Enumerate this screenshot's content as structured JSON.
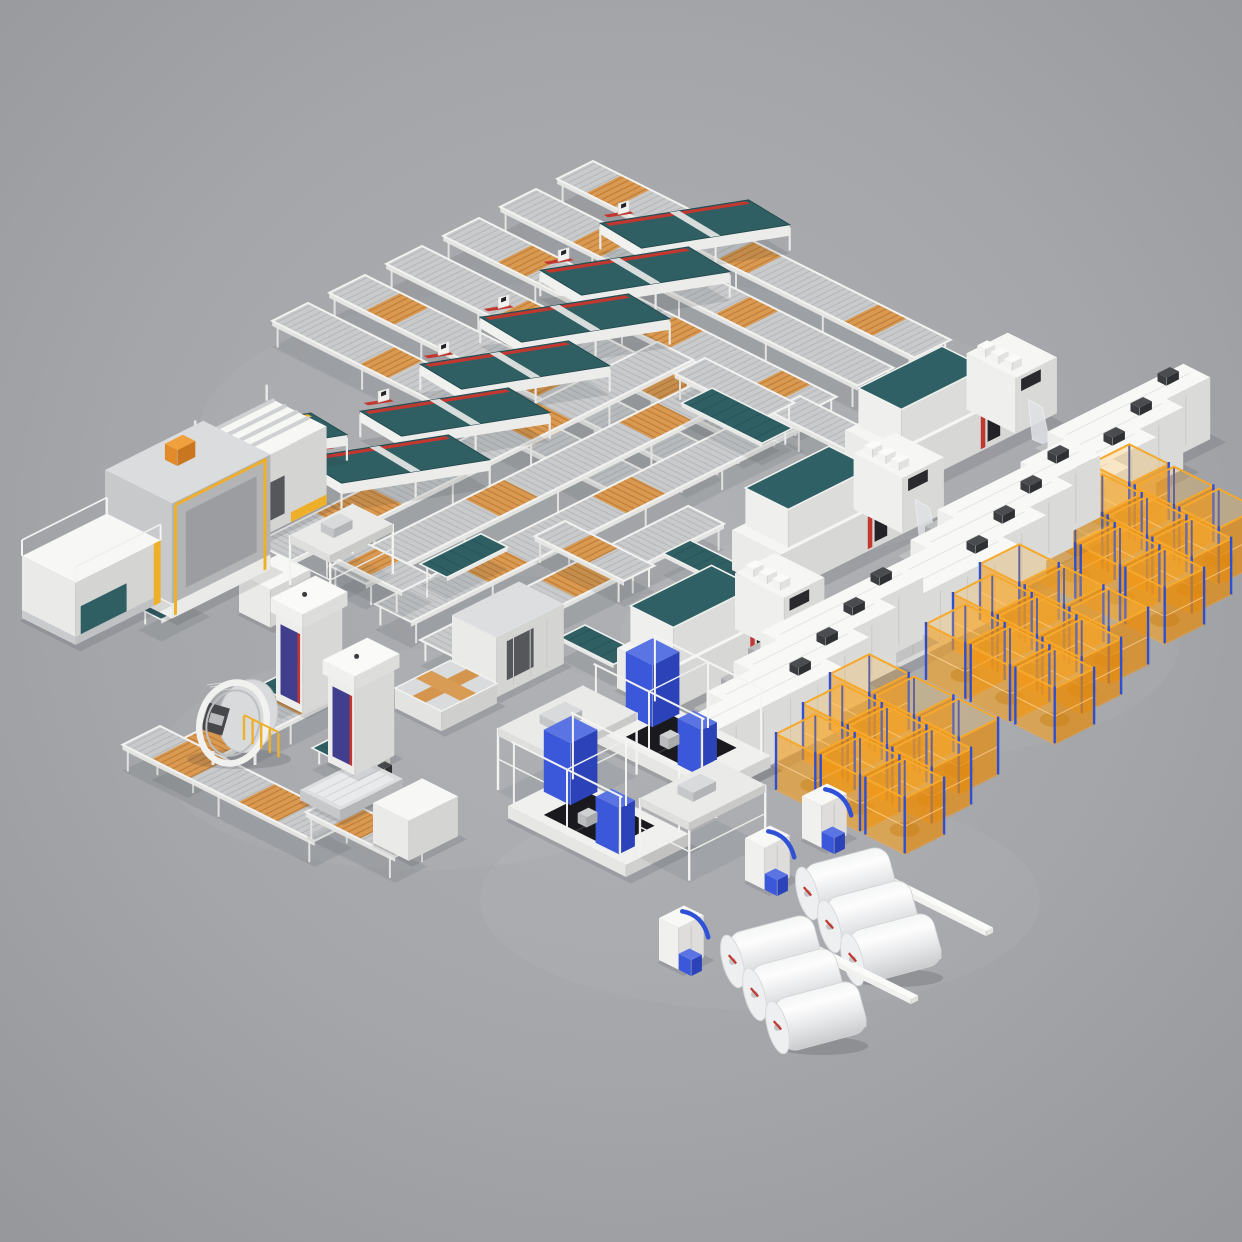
{
  "scene": {
    "subject": "isometric-3d-render-automated-textile-production-line",
    "canvas": {
      "width": 1242,
      "height": 1242
    },
    "palette": {
      "bg_center": "#aeb0b4",
      "bg_mid": "#a4a6aa",
      "bg_edge": "#95979b",
      "frame_white": "#f2f2f0",
      "silver": "#c8cacc",
      "roller_stripe": "#b5b7b9",
      "orange_roller": "#d99950",
      "orange_dark": "#bf7d3a",
      "teal": "#2f5f63",
      "teal_dark": "#27545a",
      "red": "#c23730",
      "yellow": "#eeb02a",
      "cage_orange": "#f4a01a",
      "cage_blue": "#2d4fd4",
      "machine_blue": "#3c58da",
      "machine_blue_dark": "#2b42b8",
      "indigo_door": "#413e8e",
      "black_panel": "#1a1a1e",
      "body_gray": "#c7c9cb",
      "shadow": "rgba(44,46,52,0.13)"
    },
    "elements": [
      {
        "type": "conv",
        "name": "grid-rail-b1",
        "dir": "B",
        "x": 593,
        "y": 185,
        "len": 400,
        "w": 40,
        "orange": [
          [
            0.08,
            0.16
          ],
          [
            0.45,
            0.53
          ],
          [
            0.8,
            0.88
          ]
        ]
      },
      {
        "type": "conv",
        "name": "grid-rail-b2",
        "dir": "B",
        "x": 536,
        "y": 213,
        "len": 400,
        "w": 40,
        "orange": [
          [
            0.2,
            0.28
          ],
          [
            0.6,
            0.68
          ]
        ]
      },
      {
        "type": "conv",
        "name": "grid-rail-b3",
        "dir": "B",
        "x": 479,
        "y": 242,
        "len": 400,
        "w": 40,
        "orange": [
          [
            0.15,
            0.23
          ],
          [
            0.55,
            0.63
          ],
          [
            0.85,
            0.93
          ]
        ]
      },
      {
        "type": "conv",
        "name": "grid-rail-b4",
        "dir": "B",
        "x": 422,
        "y": 270,
        "len": 400,
        "w": 40,
        "orange": [
          [
            0.3,
            0.38
          ],
          [
            0.7,
            0.78
          ]
        ]
      },
      {
        "type": "conv",
        "name": "grid-rail-b5",
        "dir": "B",
        "x": 365,
        "y": 299,
        "len": 400,
        "w": 40,
        "orange": [
          [
            0.1,
            0.18
          ],
          [
            0.5,
            0.58
          ]
        ]
      },
      {
        "type": "conv",
        "name": "grid-rail-b6",
        "dir": "B",
        "x": 308,
        "y": 327,
        "len": 390,
        "w": 40,
        "orange": [
          [
            0.25,
            0.33
          ],
          [
            0.65,
            0.73
          ]
        ]
      },
      {
        "type": "conv",
        "name": "grid-rail-a1",
        "dir": "A",
        "x": 255,
        "y": 567,
        "len": 450,
        "w": 40,
        "orange": [
          [
            0.15,
            0.28
          ],
          [
            0.6,
            0.7
          ]
        ]
      },
      {
        "type": "conv",
        "name": "grid-rail-a2",
        "dir": "A",
        "x": 330,
        "y": 590,
        "len": 430,
        "w": 40,
        "orange": [
          [
            0.35,
            0.45
          ],
          [
            0.75,
            0.85
          ]
        ]
      },
      {
        "type": "conv",
        "name": "grid-rail-a3",
        "dir": "A",
        "x": 375,
        "y": 628,
        "len": 440,
        "w": 40,
        "orange": [
          [
            0.2,
            0.3
          ],
          [
            0.55,
            0.65
          ]
        ]
      },
      {
        "type": "conv",
        "name": "grid-rail-a4",
        "dir": "A",
        "x": 420,
        "y": 664,
        "len": 300,
        "w": 40,
        "orange": [
          [
            0.45,
            0.6
          ]
        ]
      },
      {
        "type": "conv",
        "name": "m1-infeed-rail",
        "dir": "B",
        "x": 800,
        "y": 420,
        "len": 100,
        "w": 34,
        "orange": []
      },
      {
        "type": "conv",
        "name": "m2-infeed-rail",
        "dir": "B",
        "x": 705,
        "y": 382,
        "len": 100,
        "w": 34,
        "orange": []
      },
      {
        "type": "conv",
        "name": "m3-link-rail",
        "dir": "B",
        "x": 565,
        "y": 545,
        "len": 100,
        "w": 34,
        "orange": [
          [
            0.3,
            0.6
          ]
        ]
      },
      {
        "type": "conv",
        "name": "west-link-rail",
        "dir": "B",
        "x": 352,
        "y": 560,
        "len": 90,
        "w": 34,
        "orange": [
          [
            0.3,
            0.6
          ]
        ]
      },
      {
        "type": "conv",
        "name": "wrapper-line-rail",
        "dir": "A",
        "x": 152,
        "y": 778,
        "len": 230,
        "w": 40,
        "orange": [
          [
            0.1,
            0.35
          ],
          [
            0.55,
            0.8
          ]
        ]
      },
      {
        "type": "conv",
        "name": "west-down-rail",
        "dir": "B",
        "x": 160,
        "y": 750,
        "len": 215,
        "w": 42,
        "orange": [
          [
            0.15,
            0.35
          ],
          [
            0.6,
            0.8
          ]
        ]
      },
      {
        "type": "conv",
        "name": "stacker-link-rail",
        "dir": "B",
        "x": 338,
        "y": 820,
        "len": 100,
        "w": 36,
        "orange": [
          [
            0.3,
            0.6
          ]
        ]
      },
      {
        "type": "bench",
        "name": "m1-deck-belt",
        "dir": "B",
        "x": 712,
        "y": 408,
        "len": 90,
        "w": 34
      },
      {
        "type": "bench",
        "name": "m2-deck-belt",
        "dir": "B",
        "x": 690,
        "y": 560,
        "len": 70,
        "w": 30
      },
      {
        "type": "bench",
        "name": "m3-deck-belt",
        "dir": "B",
        "x": 585,
        "y": 645,
        "len": 60,
        "w": 28
      },
      {
        "type": "bench",
        "name": "grid-exit-ramp",
        "dir": "A",
        "x": 420,
        "y": 584,
        "len": 68,
        "w": 30
      },
      {
        "type": "bench",
        "name": "portal-a-belt",
        "dir": "A",
        "x": 258,
        "y": 706,
        "len": 60,
        "w": 26
      },
      {
        "type": "bench",
        "name": "portal-b-belt",
        "dir": "A",
        "x": 312,
        "y": 768,
        "len": 60,
        "w": 26
      },
      {
        "type": "bench",
        "name": "feed-belt",
        "dir": "A",
        "x": 138,
        "y": 628,
        "len": 55,
        "w": 26
      },
      {
        "type": "table",
        "name": "sewing-station-1",
        "x": 695,
        "y": 250,
        "len": 150,
        "wid": 48,
        "stripe": "red",
        "head": true
      },
      {
        "type": "table",
        "name": "sewing-station-2",
        "x": 635,
        "y": 297,
        "len": 150,
        "wid": 48,
        "stripe": "red",
        "head": true
      },
      {
        "type": "table",
        "name": "sewing-station-3",
        "x": 575,
        "y": 344,
        "len": 150,
        "wid": 48,
        "stripe": "red",
        "head": true
      },
      {
        "type": "table",
        "name": "sewing-station-4",
        "x": 515,
        "y": 391,
        "len": 150,
        "wid": 48,
        "stripe": "red",
        "head": true
      },
      {
        "type": "table",
        "name": "sewing-station-5",
        "x": 455,
        "y": 438,
        "len": 150,
        "wid": 48,
        "stripe": "red",
        "head": true
      },
      {
        "type": "table",
        "name": "sewing-station-6",
        "x": 395,
        "y": 485,
        "len": 150,
        "wid": 48,
        "stripe": "red",
        "head": true
      },
      {
        "type": "table",
        "name": "entry-table",
        "x": 277,
        "y": 458,
        "len": 105,
        "wid": 42,
        "stripe": "yellow",
        "head": false
      },
      {
        "type": "rollerMachine",
        "name": "unwind-machine",
        "x": 188,
        "y": 520
      },
      {
        "type": "box",
        "name": "sheet-stack",
        "x": 239,
        "y": 612,
        "w": 45,
        "d": 35,
        "h": 38,
        "opts": {}
      },
      {
        "type": "gantry",
        "name": "loader-gantry",
        "x": 290,
        "y": 585,
        "w": 70,
        "d": 45,
        "h": 50
      },
      {
        "type": "bigGantry",
        "name": "laminator-gantry",
        "x": 105,
        "y": 585
      },
      {
        "type": "edgeMachine",
        "name": "edge-banding-machine",
        "x": 22,
        "y": 618
      },
      {
        "type": "quilter",
        "name": "quilting-machine-1",
        "x": 845,
        "y": 470,
        "w": 170
      },
      {
        "type": "dryerRow",
        "name": "dryer-row-1",
        "anchors": [
          [
            1035,
            500
          ],
          [
            1008,
            530
          ],
          [
            981,
            560
          ],
          [
            954,
            590
          ]
        ]
      },
      {
        "type": "cageGroup",
        "name": "cage-group-1",
        "x": 1090,
        "y": 520,
        "rows": 3,
        "cols": 3
      },
      {
        "type": "quilter",
        "name": "quilting-machine-2",
        "x": 732,
        "y": 570,
        "w": 170
      },
      {
        "type": "dryerRow",
        "name": "dryer-row-2",
        "anchors": [
          [
            925,
            578
          ],
          [
            898,
            608
          ],
          [
            871,
            638
          ],
          [
            844,
            668
          ]
        ]
      },
      {
        "type": "cageGroup",
        "name": "cage-group-2",
        "x": 980,
        "y": 620,
        "rows": 3,
        "cols": 3
      },
      {
        "type": "box",
        "name": "center-machine",
        "x": 452,
        "y": 675,
        "w": 75,
        "d": 50,
        "h": 60,
        "opts": {
          "seams": 3,
          "slot": [
            0.15,
            0.55
          ],
          "grayTop": true
        }
      },
      {
        "type": "crosstable",
        "name": "transfer-cross-table",
        "x": 395,
        "y": 708
      },
      {
        "type": "tower",
        "name": "panel-portal-1",
        "x": 276,
        "y": 700,
        "h": 88
      },
      {
        "type": "ring",
        "name": "wrapping-ring-machine",
        "x": 233,
        "y": 723
      },
      {
        "type": "quilter",
        "name": "quilting-machine-3",
        "x": 617,
        "y": 688,
        "w": 165
      },
      {
        "type": "dryerRow",
        "name": "dryer-row-3",
        "anchors": [
          [
            748,
            700
          ],
          [
            721,
            730
          ],
          [
            694,
            760
          ],
          [
            667,
            790
          ]
        ]
      },
      {
        "type": "cageGroup",
        "name": "cage-group-3",
        "x": 830,
        "y": 730,
        "rows": 3,
        "cols": 3
      },
      {
        "type": "inspector",
        "name": "inspection-machine-2",
        "x": 590,
        "y": 740
      },
      {
        "type": "gantry",
        "name": "infeed-gantry",
        "x": 498,
        "y": 790,
        "w": 95,
        "d": 60,
        "h": 62
      },
      {
        "type": "column",
        "name": "stacker-robot",
        "x": 350,
        "y": 800
      },
      {
        "type": "pallet",
        "name": "sheet-pallet",
        "x": 300,
        "y": 800
      },
      {
        "type": "tower",
        "name": "panel-portal-2",
        "x": 328,
        "y": 762,
        "h": 88
      },
      {
        "type": "winder",
        "name": "winder-head-1",
        "x": 802,
        "y": 838
      },
      {
        "type": "box",
        "name": "outfeed-table",
        "x": 373,
        "y": 843,
        "w": 55,
        "d": 40,
        "h": 40,
        "opts": {}
      },
      {
        "type": "inspector",
        "name": "inspection-machine-1",
        "x": 508,
        "y": 818
      },
      {
        "type": "gantry",
        "name": "winder-gantry",
        "x": 640,
        "y": 856,
        "w": 85,
        "d": 55,
        "h": 58
      },
      {
        "type": "winder",
        "name": "winder-head-2",
        "x": 745,
        "y": 880
      },
      {
        "type": "rollGroup",
        "name": "fabric-rolls-1",
        "stand": [
          800,
          895
        ],
        "mids": [
          [
            850,
            882
          ],
          [
            872,
            915
          ],
          [
            895,
            948
          ]
        ]
      },
      {
        "type": "winder",
        "name": "winder-head-3",
        "x": 659,
        "y": 960
      },
      {
        "type": "rollGroup",
        "name": "fabric-rolls-2",
        "stand": [
          725,
          963
        ],
        "mids": [
          [
            775,
            950
          ],
          [
            797,
            983
          ],
          [
            820,
            1016
          ]
        ]
      }
    ]
  }
}
